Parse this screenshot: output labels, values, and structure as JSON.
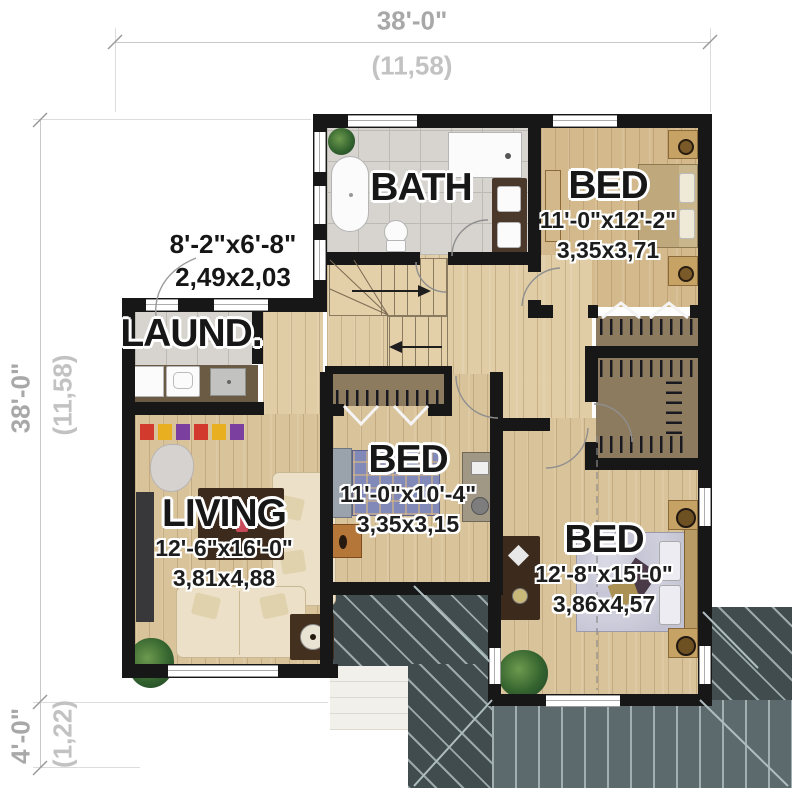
{
  "plan": {
    "title": "second-floor-plan",
    "dim_top": {
      "imperial": "38'-0\"",
      "metric": "(11,58)"
    },
    "dim_left": {
      "imperial": "38'-0\"",
      "metric": "(11,58)"
    },
    "dim_bottom_left": {
      "imperial": "4'-0\"",
      "metric": "(1,22)"
    },
    "rooms": {
      "bath": {
        "name": "BATH"
      },
      "laundry": {
        "name": "LAUND.",
        "imperial": "8'-2\"x6'-8\"",
        "metric": "2,49x2,03"
      },
      "bed_top": {
        "name": "BED",
        "imperial": "11'-0\"x12'-2\"",
        "metric": "3,35x3,71"
      },
      "bed_mid": {
        "name": "BED",
        "imperial": "11'-0\"x10'-4\"",
        "metric": "3,35x3,15"
      },
      "bed_bottom": {
        "name": "BED",
        "imperial": "12'-8\"x15'-0\"",
        "metric": "3,86x4,57"
      },
      "living": {
        "name": "LIVING",
        "imperial": "12'-6\"x16'-0\"",
        "metric": "3,81x4,88"
      }
    },
    "colors": {
      "wall": "#171717",
      "wood": "#d9c39a",
      "tile": "#d7d4cf",
      "roof_dark": "#414c4f",
      "roof_mid": "#5c6a6d",
      "closet_shelf": "#8d7b5f",
      "dim_text": "#a8a8a8"
    }
  }
}
